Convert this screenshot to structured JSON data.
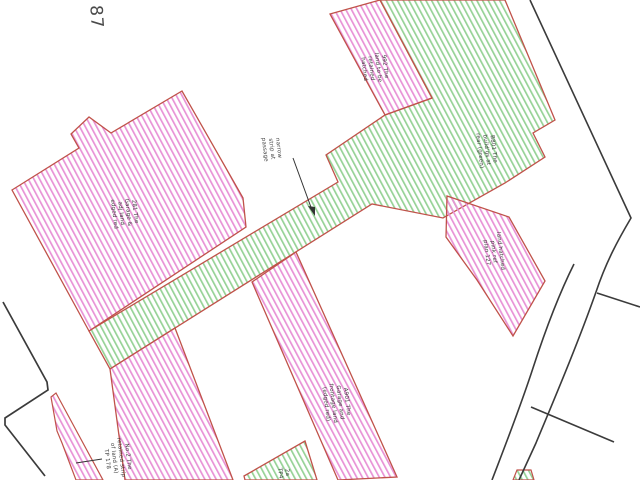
{
  "document": {
    "kind": "title-plan-extract",
    "plot_number": "87"
  },
  "colors": {
    "background": "#ffffff",
    "pink_hatch": "#e892d6",
    "green_hatch": "#96d296",
    "parcel_outline_red": "#c0524a",
    "boundary_black": "#3b3b3b",
    "label_text": "#3a3a3a"
  },
  "parcels": [
    {
      "name": "large-pink-parcel-left",
      "hatch": "pink",
      "outline": "red"
    },
    {
      "name": "green-strip-and-band",
      "hatch": "green",
      "outline": "red"
    },
    {
      "name": "top-pink-strip",
      "hatch": "pink",
      "outline": "red"
    },
    {
      "name": "right-pink-parcel",
      "hatch": "pink",
      "outline": "red"
    },
    {
      "name": "bottom-left-pink-strip",
      "hatch": "pink",
      "outline": "red"
    },
    {
      "name": "bottom-centre-pink-strip",
      "hatch": "pink",
      "outline": "red"
    },
    {
      "name": "bottom-left-sliver",
      "hatch": "pink",
      "outline": "red"
    },
    {
      "name": "bottom-centre-green-piece",
      "hatch": "green",
      "outline": "red"
    },
    {
      "name": "bottom-right-green-sliver",
      "hatch": "green",
      "outline": "red"
    }
  ],
  "annotations": {
    "plot_number": "87",
    "labels": [
      {
        "name": "label-large-pink-parcel",
        "text": "281 The\nGarage &\nadj land\nedged red"
      },
      {
        "name": "label-passage-strip",
        "text": "narrow\nstrip at\npassage"
      },
      {
        "name": "label-top-pink-strip",
        "text": "992 The\nland to be\nretained\nhatched"
      },
      {
        "name": "label-top-right-green",
        "text": "B801 The\nbuild'gs at\nrear (green)"
      },
      {
        "name": "label-right-pink-parcel",
        "text": "land hatched\npink ref\nplan 127"
      },
      {
        "name": "label-bottom-pink-strip",
        "text": "A901 The\nGarage and\nfrontage land\n(edged red)"
      },
      {
        "name": "label-bottom-left-sliver",
        "text": "No.2 The\nretained strip\nof land (A)\nTP 178"
      },
      {
        "name": "label-bottom-green",
        "text": "2a\nTP4"
      }
    ]
  }
}
